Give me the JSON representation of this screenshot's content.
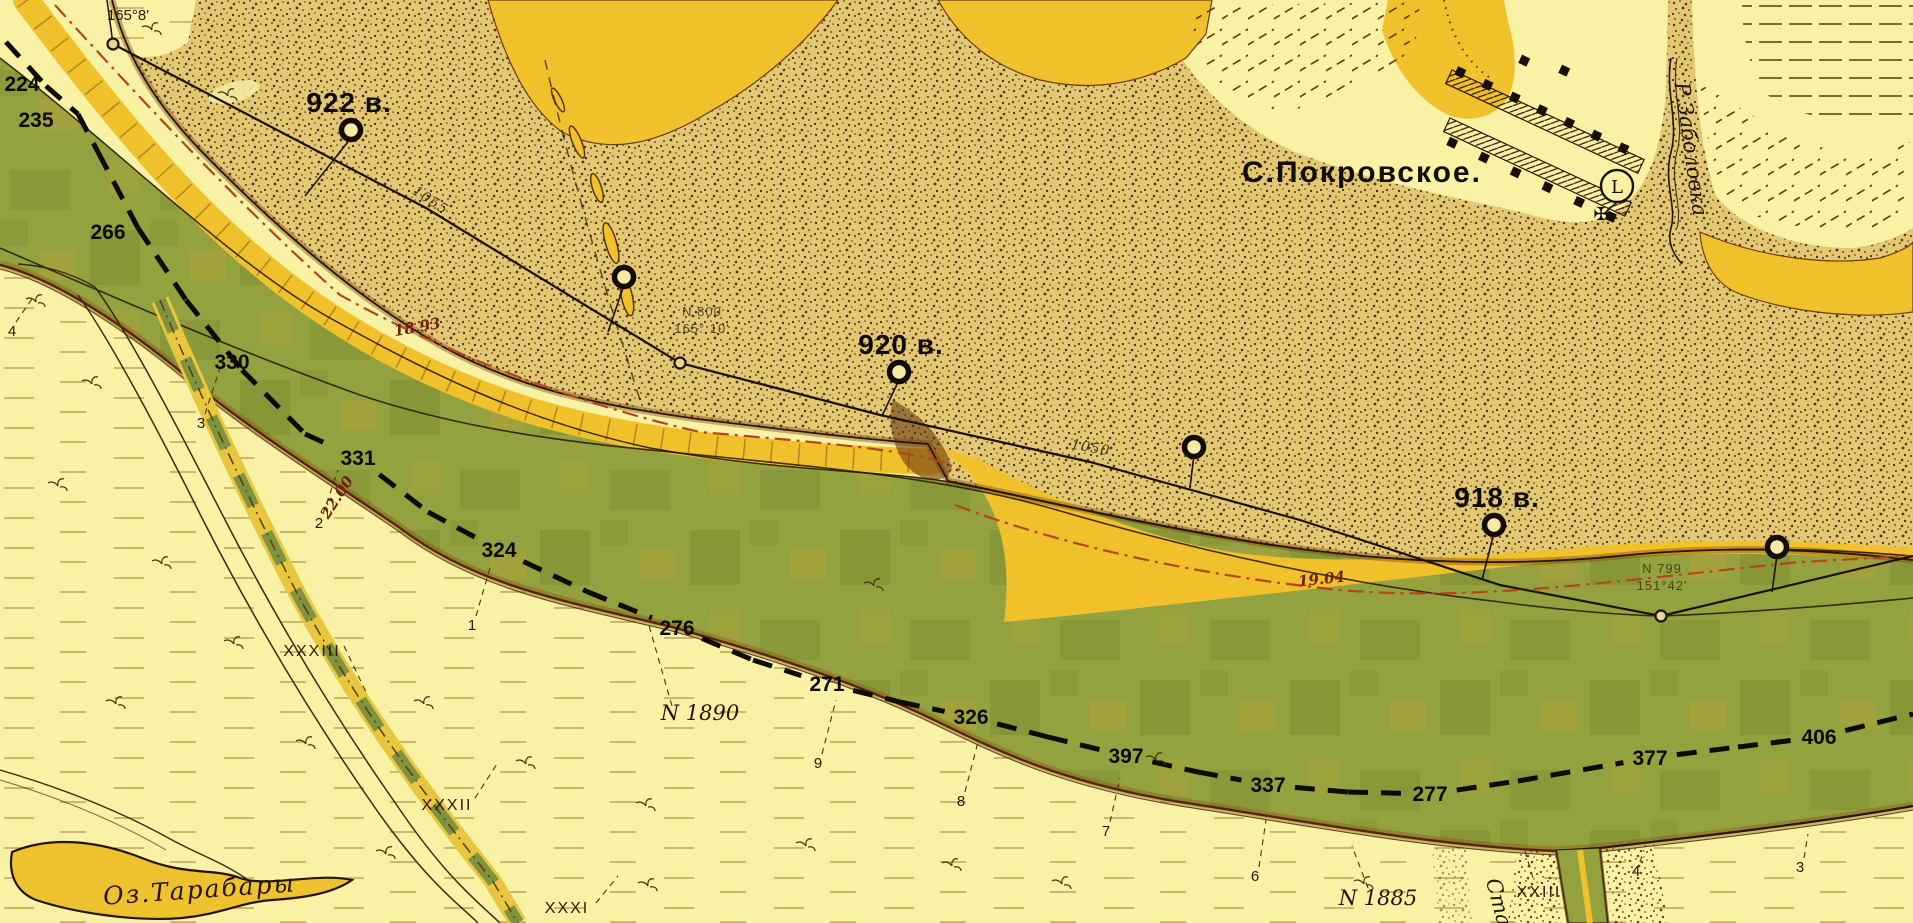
{
  "map": {
    "colors": {
      "green": "#93a23e",
      "sand": "#e2c873",
      "gold": "#f0c12b",
      "cream": "#f9f2a4",
      "ink": "#1a1205",
      "red_line": "#b5451c",
      "red_text": "#6e2208"
    },
    "place_labels": {
      "village": "С.Покровское.",
      "lake": "Оз.Тарабары",
      "stream": "Р.Заболовка",
      "gully": "Ста"
    },
    "bearing_top_left": "165°8'",
    "symbols": {
      "circled_letter": "L",
      "church_cross": "✠"
    },
    "survey": {
      "baseline": [
        [
          113,
          44
        ],
        [
          426,
          208
        ],
        [
          680,
          363
        ],
        [
          880,
          415
        ],
        [
          1090,
          462
        ],
        [
          1300,
          520
        ],
        [
          1500,
          585
        ],
        [
          1661,
          616
        ],
        [
          1913,
          556
        ]
      ],
      "station_circles": [
        [
          113,
          44
        ],
        [
          680,
          363
        ],
        [
          1661,
          616
        ]
      ],
      "station_texts": [
        {
          "name": "N 800",
          "bearing": "165° 10'",
          "x": 702,
          "y": 316
        },
        {
          "name": "N 799",
          "bearing": "151°42'",
          "x": 1662,
          "y": 573
        }
      ],
      "distance_labels": [
        {
          "t": "1055",
          "x": 428,
          "y": 204,
          "rot": 33
        },
        {
          "t": "1050",
          "x": 1090,
          "y": 452,
          "rot": 10
        }
      ]
    },
    "versts": [
      {
        "label": "922 в.",
        "cx": 351,
        "cy": 130,
        "lx": 349,
        "ly": 112,
        "fx": 305,
        "fy": 196
      },
      {
        "label": "",
        "cx": 624,
        "cy": 277,
        "lx": 0,
        "ly": 0,
        "fx": 608,
        "fy": 332
      },
      {
        "label": "920 в.",
        "cx": 899,
        "cy": 372,
        "lx": 901,
        "ly": 354,
        "fx": 882,
        "fy": 416
      },
      {
        "label": "",
        "cx": 1194,
        "cy": 447,
        "lx": 0,
        "ly": 0,
        "fx": 1190,
        "fy": 487
      },
      {
        "label": "918 в.",
        "cx": 1494,
        "cy": 525,
        "lx": 1497,
        "ly": 507,
        "fx": 1482,
        "fy": 580
      },
      {
        "label": "",
        "cx": 1777,
        "cy": 547,
        "lx": 0,
        "ly": 0,
        "fx": 1772,
        "fy": 592
      }
    ],
    "fairway": {
      "path": [
        [
          6,
          42
        ],
        [
          46,
          86
        ],
        [
          78,
          114
        ],
        [
          98,
          152
        ],
        [
          138,
          228
        ],
        [
          186,
          300
        ],
        [
          242,
          370
        ],
        [
          305,
          434
        ],
        [
          358,
          458
        ],
        [
          428,
          512
        ],
        [
          499,
          550
        ],
        [
          588,
          592
        ],
        [
          677,
          628
        ],
        [
          753,
          660
        ],
        [
          827,
          684
        ],
        [
          900,
          702
        ],
        [
          971,
          717
        ],
        [
          1048,
          737
        ],
        [
          1126,
          756
        ],
        [
          1198,
          772
        ],
        [
          1268,
          785
        ],
        [
          1348,
          792
        ],
        [
          1430,
          794
        ],
        [
          1518,
          781
        ],
        [
          1650,
          758
        ],
        [
          1738,
          747
        ],
        [
          1819,
          737
        ],
        [
          1913,
          714
        ]
      ],
      "labels": [
        {
          "v": "224",
          "x": 22,
          "y": 84,
          "cut": false
        },
        {
          "v": "235",
          "x": 36,
          "y": 120,
          "cut": false
        },
        {
          "v": "266",
          "x": 108,
          "y": 232,
          "cut": false
        },
        {
          "v": "330",
          "x": 232,
          "y": 362,
          "cut": false
        },
        {
          "v": "331",
          "x": 358,
          "y": 458,
          "cut": true
        },
        {
          "v": "324",
          "x": 499,
          "y": 550,
          "cut": true
        },
        {
          "v": "276",
          "x": 677,
          "y": 628,
          "cut": true
        },
        {
          "v": "271",
          "x": 827,
          "y": 684,
          "cut": true
        },
        {
          "v": "326",
          "x": 971,
          "y": 717,
          "cut": true
        },
        {
          "v": "397",
          "x": 1126,
          "y": 756,
          "cut": true
        },
        {
          "v": "337",
          "x": 1268,
          "y": 785,
          "cut": true
        },
        {
          "v": "277",
          "x": 1430,
          "y": 794,
          "cut": true
        },
        {
          "v": "377",
          "x": 1650,
          "y": 758,
          "cut": true
        },
        {
          "v": "406",
          "x": 1819,
          "y": 737,
          "cut": true
        }
      ]
    },
    "soundings": [
      {
        "n": "4",
        "x": 12,
        "y": 336,
        "lx": 34,
        "ly": 296
      },
      {
        "n": "3",
        "x": 201,
        "y": 428,
        "lx": 220,
        "ly": 368
      },
      {
        "n": "2",
        "x": 319,
        "y": 528,
        "lx": 338,
        "ly": 470
      },
      {
        "n": "1",
        "x": 472,
        "y": 630,
        "lx": 490,
        "ly": 568
      },
      {
        "n": "9",
        "x": 818,
        "y": 768,
        "lx": 836,
        "ly": 700
      },
      {
        "n": "8",
        "x": 961,
        "y": 806,
        "lx": 978,
        "ly": 742
      },
      {
        "n": "7",
        "x": 1106,
        "y": 836,
        "lx": 1120,
        "ly": 778
      },
      {
        "n": "6",
        "x": 1255,
        "y": 881,
        "lx": 1266,
        "ly": 820
      },
      {
        "n": "4",
        "x": 1636,
        "y": 876,
        "lx": 1644,
        "ly": 850
      },
      {
        "n": "3",
        "x": 1800,
        "y": 872,
        "lx": 1808,
        "ly": 834
      }
    ],
    "cross_sections": [
      {
        "t": "XXXIII",
        "x": 312,
        "y": 656,
        "lx1": 344,
        "ly1": 646,
        "lx2": 366,
        "ly2": 692
      },
      {
        "t": "XXXII",
        "x": 447,
        "y": 810,
        "lx1": 475,
        "ly1": 798,
        "lx2": 497,
        "ly2": 764
      },
      {
        "t": "XXXI",
        "x": 567,
        "y": 913,
        "lx1": 596,
        "ly1": 903,
        "lx2": 618,
        "ly2": 876
      },
      {
        "t": "XXIII",
        "x": 1539,
        "y": 897,
        "lx1": 1533,
        "ly1": 878,
        "lx2": 1524,
        "ly2": 848
      }
    ],
    "profile_marks": [
      {
        "t": "N 1890",
        "x": 700,
        "y": 720,
        "lx1": 672,
        "ly1": 706,
        "lx2": 648,
        "ly2": 622
      },
      {
        "t": "N 1885",
        "x": 1378,
        "y": 905,
        "lx1": 1368,
        "ly1": 888,
        "lx2": 1352,
        "ly2": 846
      }
    ],
    "water_levels": [
      {
        "t": "18.93",
        "x": 418,
        "y": 332,
        "rot": -10
      },
      {
        "t": "22.00",
        "x": 341,
        "y": 500,
        "rot": -57
      },
      {
        "t": "19.04",
        "x": 1322,
        "y": 584,
        "rot": -6
      }
    ]
  }
}
